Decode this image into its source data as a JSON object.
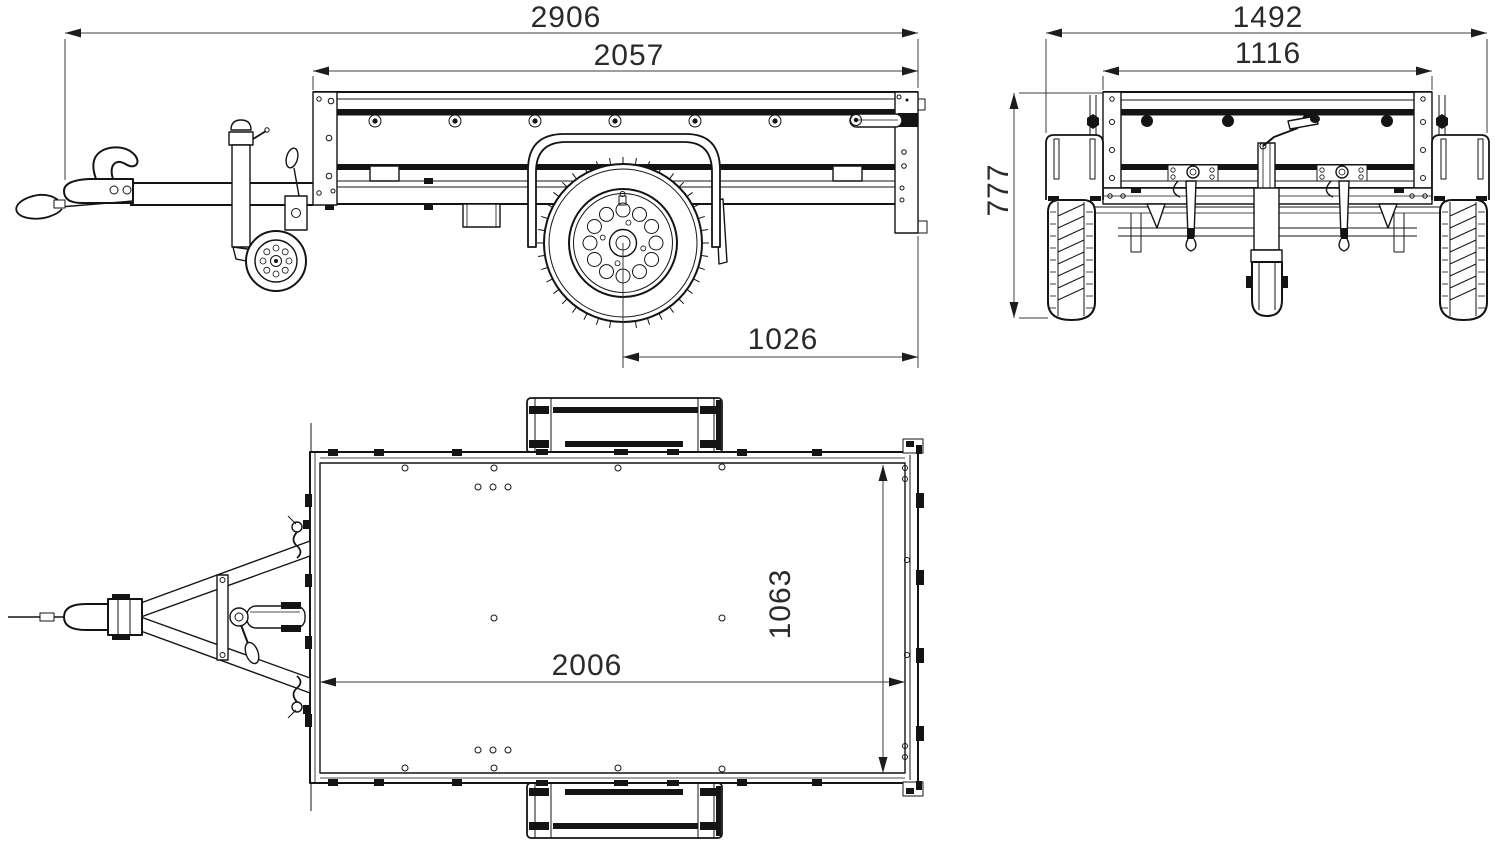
{
  "dimensions_mm": {
    "side_view": {
      "overall_length": "2906",
      "bed_length": "2057",
      "axle_to_rear": "1026"
    },
    "front_view": {
      "overall_width": "1492",
      "inner_width": "1116",
      "overall_height": "777"
    },
    "top_view": {
      "bed_inner_length": "2006",
      "bed_inner_width": "1063"
    }
  },
  "colors": {
    "outline": "#141414",
    "dimension": "#3c3c3c",
    "label_text": "#2a2a2a",
    "background": "#ffffff"
  }
}
